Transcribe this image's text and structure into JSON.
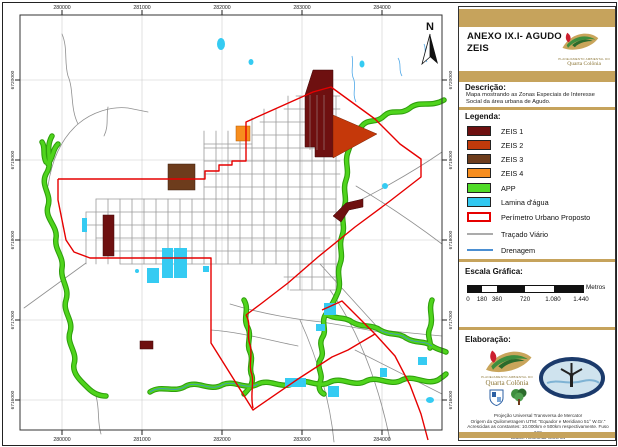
{
  "header": {
    "title_line1": "ANEXO IX.I- AGUDO",
    "title_line2": "ZEIS",
    "logo_caption": "PLANEJAMENTO AMBIENTAL DO",
    "logo_name": "Quarta Colônia"
  },
  "description": {
    "heading": "Descrição:",
    "text": "Mapa mostrando as Zonas Especiais de Interesse Social da área urbana de Agudo."
  },
  "legend": {
    "heading": "Legenda:",
    "items": [
      {
        "label": "ZEIS 1",
        "color": "#6E1010"
      },
      {
        "label": "ZEIS 2",
        "color": "#C13A0B"
      },
      {
        "label": "ZEIS 3",
        "color": "#6D3C1C"
      },
      {
        "label": "ZEIS 4",
        "color": "#F68D1E"
      },
      {
        "label": "APP",
        "color": "#50DC28"
      },
      {
        "label": "Lamina d'água",
        "color": "#32C8F0"
      },
      {
        "label": "Perímetro Urbano Proposto",
        "color": "#E60000"
      },
      {
        "label": "Traçado Viário",
        "color": "#ABABAB"
      },
      {
        "label": "Drenagem",
        "color": "#4B8FD2"
      }
    ]
  },
  "scale": {
    "heading": "Escala Gráfica:",
    "unit": "Metros",
    "ticks": [
      "0",
      "180",
      "360",
      "720",
      "1.080",
      "1.440"
    ]
  },
  "elaboration": {
    "heading": "Elaboração:",
    "notes": [
      "Projeção Universal Transversa de Mercator",
      "Origem da Quilometragem UTM: \"Equador e Meridiano 51° W.Gr.\"",
      "Acrescidas as constantes: 10.000km e 500km respectivamente. Fuso 22S",
      "Datum Horizontal WGS 84"
    ]
  },
  "map": {
    "north_label": "N",
    "x_labels": [
      "280000",
      "281000",
      "282000",
      "283000",
      "284000"
    ],
    "y_labels": [
      "6720000",
      "6719000",
      "6718000",
      "6717000",
      "6716000"
    ]
  },
  "colors": {
    "band": "#C6A35C",
    "zeis1": "#6E1010",
    "zeis2": "#C13A0B",
    "zeis3": "#6D3C1C",
    "zeis4": "#F68D1E",
    "app": "#50DC28",
    "water": "#32C8F0",
    "perimeter": "#E60000",
    "road": "#ABABAB",
    "drainage": "#4B8FD2"
  }
}
